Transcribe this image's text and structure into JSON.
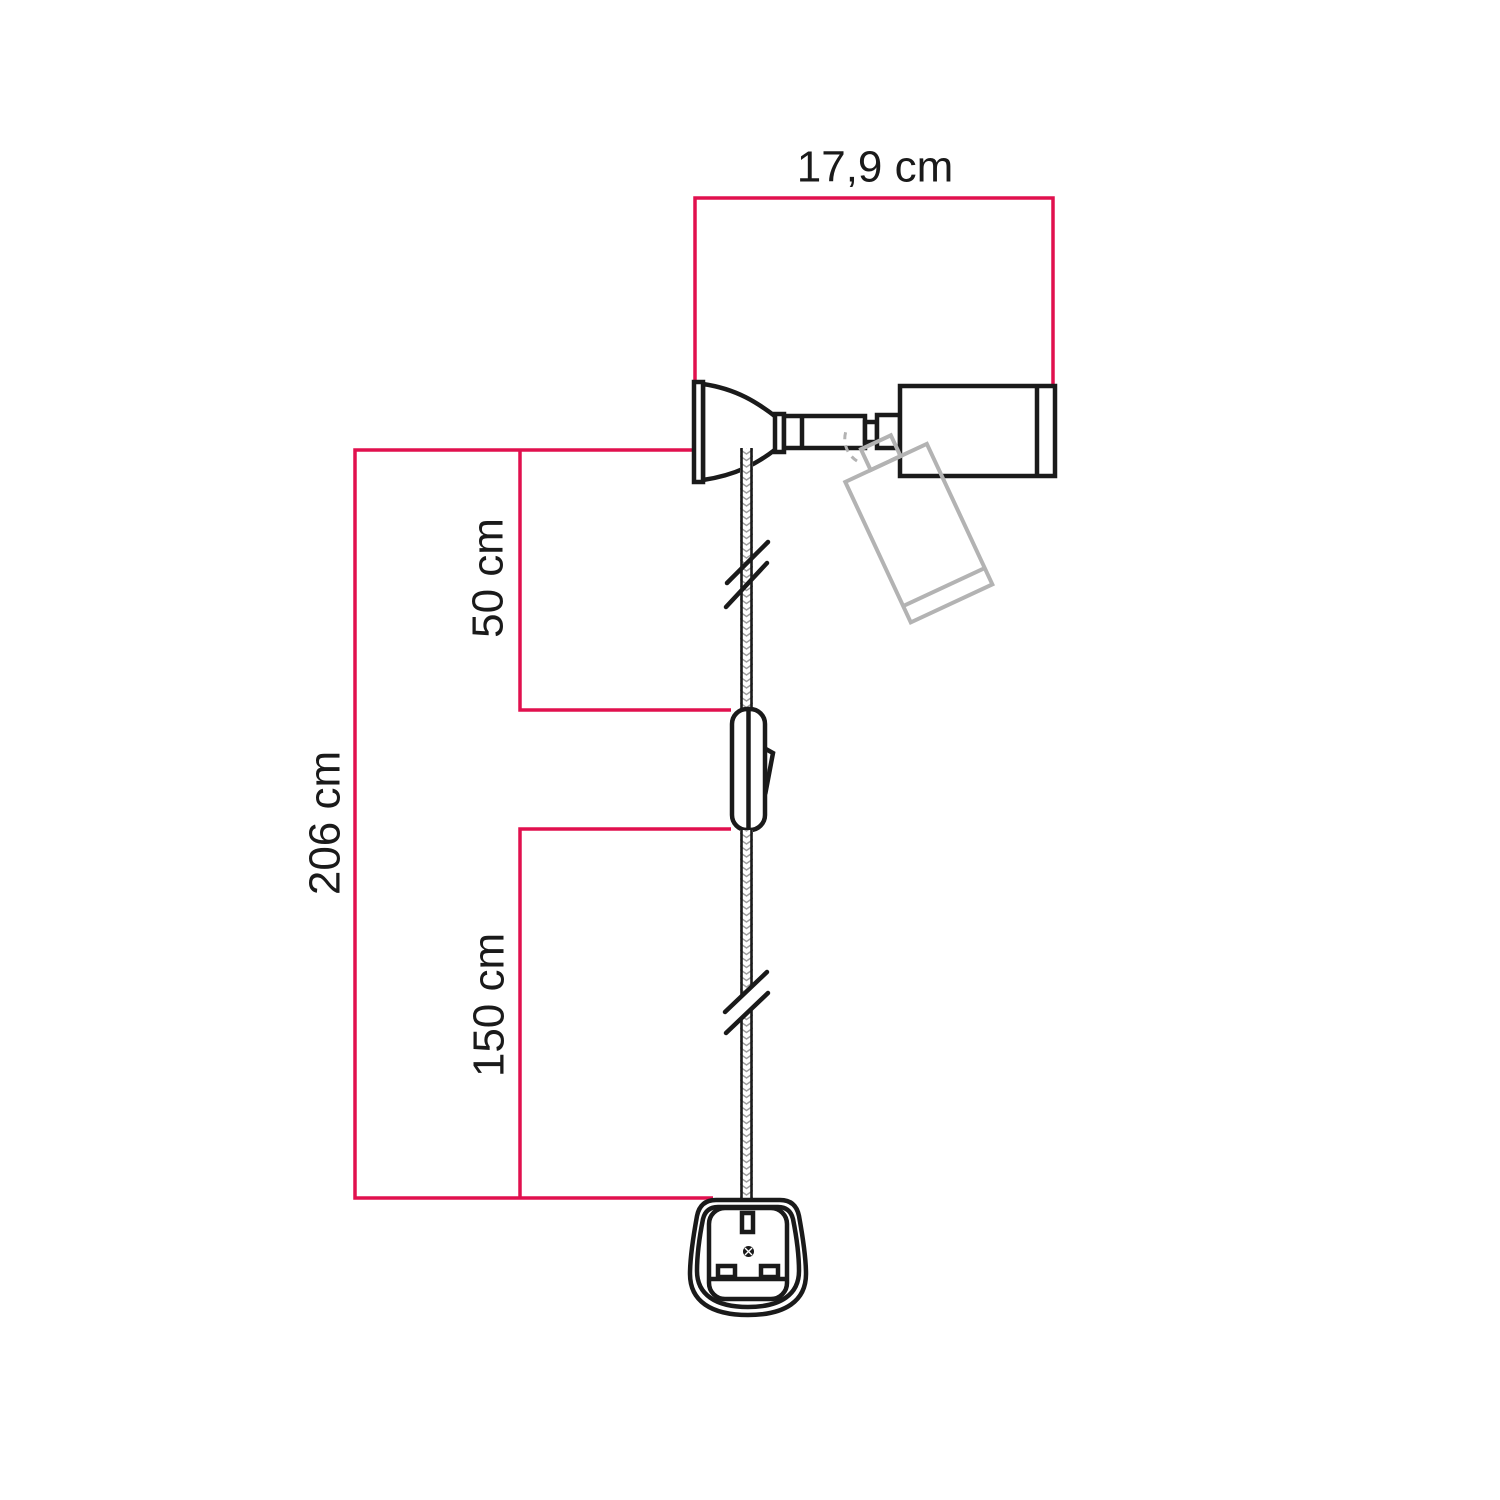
{
  "diagram": {
    "labels": {
      "width": "17,9 cm",
      "upper_cable": "50 cm",
      "total_cable": "206 cm",
      "lower_cable": "150 cm"
    },
    "colors": {
      "dimension_line": "#e1104e",
      "outline": "#1a1a1a",
      "ghost_outline": "#b3b3b3",
      "cable_hatch": "#a0a0a0",
      "background": "#ffffff"
    }
  }
}
